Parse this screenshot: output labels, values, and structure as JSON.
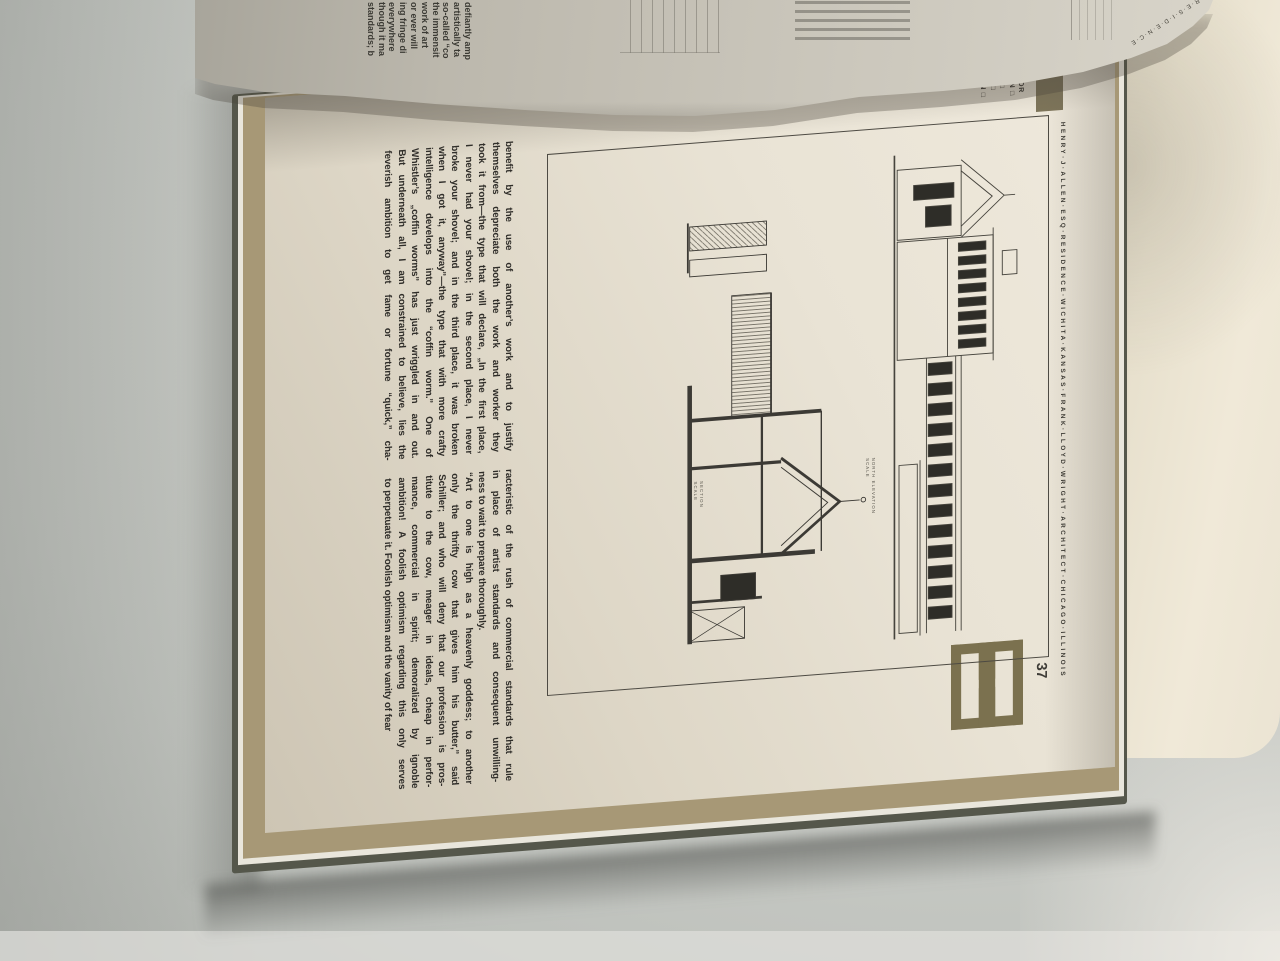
{
  "colors": {
    "page": "#e9e3d5",
    "table": "#c8cac5",
    "edge_tan": "#a79876",
    "cover": "#55574b",
    "logo_olive": "#7b714f",
    "accent_olive": "#7d7459",
    "ink": "#2f2d29"
  },
  "page": {
    "number": "37",
    "header_lines": [
      "ENCE FOR",
      "J. ALLEN □",
      "NORTH □",
      "VATION □",
      "SECTION □"
    ],
    "caption": "HENRY·J·ALLEN·ESQ·RESIDENCE·WICHITA·KANSAS·FRANK·LLOYD·WRIGHT·ARCHITECT·CHICAGO·ILLINOIS",
    "plate": {
      "elevation_label_line1": "NORTH ELEVATION",
      "elevation_label_line2": "SCALE",
      "section_label_line1": "SECTION",
      "section_label_line2": "SCALE"
    },
    "text_column_1": [
      "benefit by the use of another’s work and to justify",
      "themselves depreciate both the work and worker they",
      "took it from—the type that will declare, „In the first place,",
      "I never had your shovel; in the second place, I never",
      "broke your shovel; and in the third place, it was broken",
      "when I got it, anyway”—the type that with more crafty",
      "intelligence develops into the “coffin worm.” One of",
      "Whistler’s „coffin worms” has just wriggled in and out.",
      "But underneath all, I am constrained to believe, lies the",
      "feverish ambition to get fame or fortune “quick,” cha-"
    ],
    "text_column_2": [
      "racteristic of the rush of commercial standards that rule",
      "in place of artist standards and consequent unwilling-",
      "ness to wait to prepare thoroughly.",
      "“Art to one is high as a heavenly goddess; to another",
      "only the thrifty cow that gives him his butter,” said",
      "Schiller; and who will deny that our profession is pros-",
      "titute to the cow, meager in ideals, cheap in perfor-",
      "mance, commercial in spirit; demoralized by ignoble",
      "ambition! A foolish optimism regarding this only serves",
      "to perpetuate it. Foolish optimism and the vanity of fear"
    ]
  },
  "turning_page": {
    "fragments": [
      "defiantly amp",
      "artistically ta",
      "so-called “co",
      "the immensit",
      "work of art",
      "or ever will",
      "ing fringe di",
      "everywhere",
      "though it ma",
      "standards; b"
    ],
    "edge_caption": "R·E·S·I·D·E·N·C·E"
  }
}
